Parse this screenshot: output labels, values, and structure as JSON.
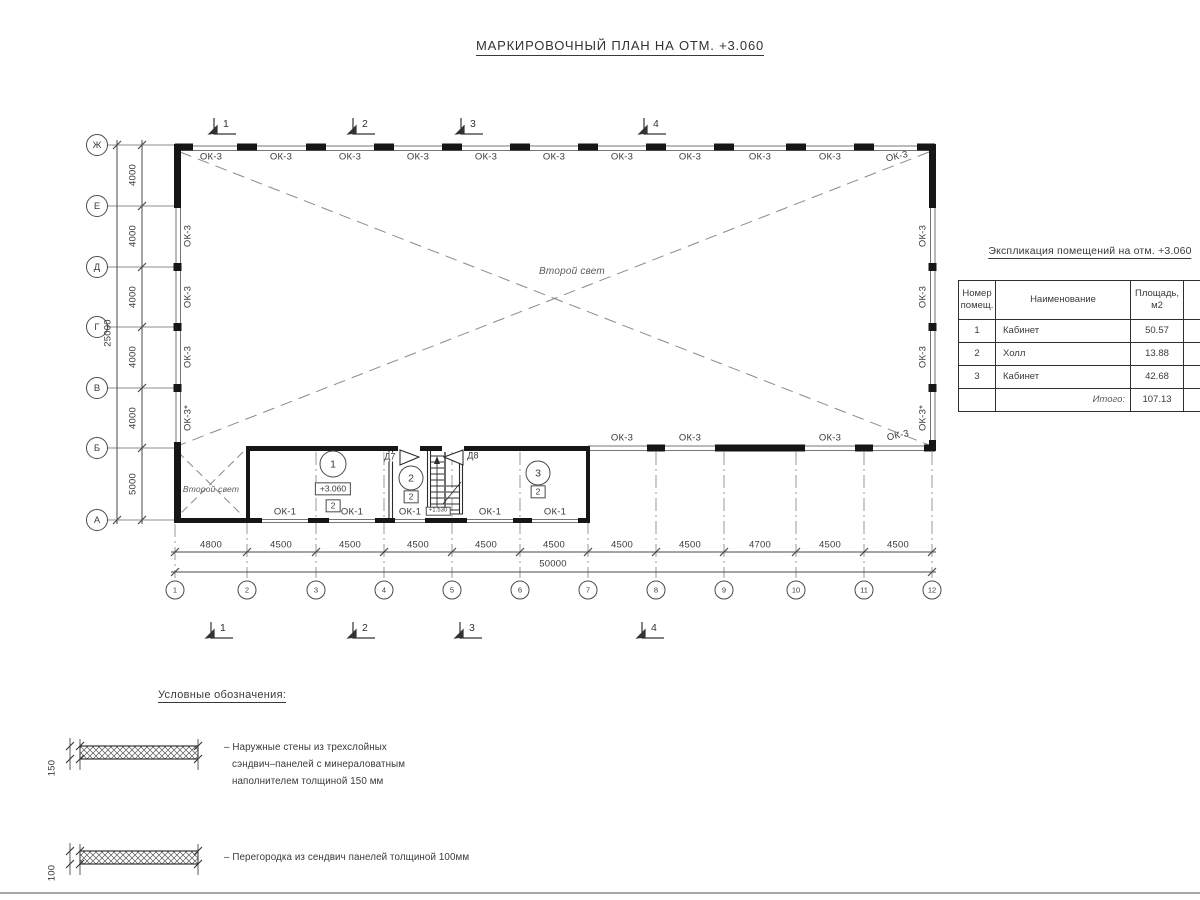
{
  "colors": {
    "ink": "#3a3a3a",
    "wall": "#161616",
    "thin_line": "#757575",
    "grid": "#8d8d8d",
    "dash": "#8a8a8a",
    "paper": "#ffffff"
  },
  "title": "МАРКИРОВОЧНЫЙ ПЛАН НА ОТМ. +3.060",
  "plan": {
    "axes_rows": [
      "Ж",
      "Е",
      "Д",
      "Г",
      "В",
      "Б",
      "А"
    ],
    "axes_cols": [
      "1",
      "2",
      "3",
      "4",
      "5",
      "6",
      "7",
      "8",
      "9",
      "10",
      "11",
      "12"
    ],
    "dims_left": [
      "4000",
      "4000",
      "4000",
      "4000",
      "4000",
      "5000"
    ],
    "dim_left_total": "25000",
    "dims_bottom": [
      "4800",
      "4500",
      "4500",
      "4500",
      "4500",
      "4500",
      "4500",
      "4500",
      "4700",
      "4500",
      "4500"
    ],
    "dim_bottom_total": "50000",
    "sections": [
      "1",
      "2",
      "3",
      "4"
    ],
    "windows": {
      "top": [
        "ОК-3",
        "ОК-3",
        "ОК-3",
        "ОК-3",
        "ОК-3",
        "ОК-3",
        "ОК-3",
        "ОК-3",
        "ОК-3",
        "ОК-3",
        "ОК-3"
      ],
      "left": [
        "ОК-3",
        "ОК-3",
        "ОК-3",
        "ОК-3*"
      ],
      "right": [
        "ОК-3",
        "ОК-3",
        "ОК-3",
        "ОК-3*"
      ],
      "axis_b": [
        "ОК-3",
        "ОК-3",
        "ОК-3",
        "ОК-3"
      ],
      "bottom": [
        "ОК-1",
        "ОК-1",
        "ОК-1",
        "ОК-1",
        "ОК-1"
      ]
    },
    "void_label": "Второй свет",
    "rooms": [
      {
        "number": "1",
        "category": "2"
      },
      {
        "number": "2",
        "category": "2"
      },
      {
        "number": "3",
        "category": "2"
      }
    ],
    "level_mark": "+3.060",
    "stair_level_mark": "+1.530",
    "doors": [
      "Д7",
      "Д8"
    ]
  },
  "table": {
    "title": "Экспликация помещений на отм. +3.060",
    "headers": [
      [
        "Номер",
        "помещ."
      ],
      [
        "Наименование"
      ],
      [
        "Площадь,",
        "м2"
      ],
      [
        "Ка",
        "по"
      ]
    ],
    "rows": [
      [
        "1",
        "Кабинет",
        "50.57"
      ],
      [
        "2",
        "Холл",
        "13.88"
      ],
      [
        "3",
        "Кабинет",
        "42.68"
      ]
    ],
    "total_label": "Итого:",
    "total_value": "107.13"
  },
  "legend": {
    "title": "Условные обозначения:",
    "items": [
      {
        "thickness": "150",
        "lines": [
          "– Наружные стены из трехслойных",
          "сэндвич–панелей с минераловатным",
          "наполнителем толщиной 150 мм"
        ]
      },
      {
        "thickness": "100",
        "lines": [
          "– Перегородка из сендвич панелей толщиной 100мм"
        ]
      }
    ]
  }
}
